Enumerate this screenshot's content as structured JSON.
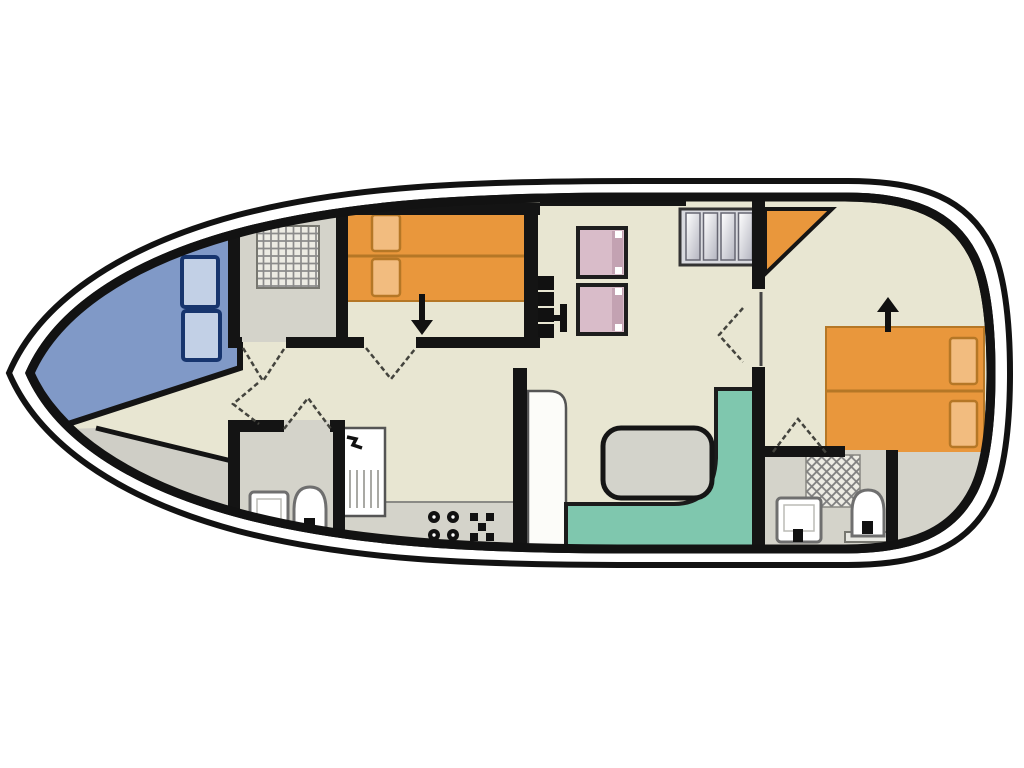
{
  "plan": {
    "type": "houseboat-deck-plan",
    "orientation": "bow-left",
    "areas": [
      "bow-seating",
      "foredeck-walkway",
      "side-deck",
      "shower-room",
      "front-cabin",
      "hallway",
      "saloon",
      "galley",
      "dinette",
      "front-bathroom",
      "aft-cabin",
      "aft-bathroom",
      "stern-locker"
    ],
    "furniture": {
      "bow_seats": 2,
      "front_cabin_double_bed": 1,
      "helm_seats": 2,
      "companionway_steps": 4,
      "stove_burners": 4,
      "dinette_table": 1,
      "aft_twin_beds": 2,
      "toilets": 2,
      "sinks": 3,
      "shower_grates": 2,
      "door_swings": 6
    },
    "colors": {
      "page_bg": "#ffffff",
      "hull_line": "#121212",
      "hull_gap": "#ffffff",
      "floor": "#e8e6d2",
      "room_gray": "#d4d3ca",
      "deck_gray": "#cfcec6",
      "wall": "#141414",
      "bow_blue": "#8099c7",
      "seat_blue_fill": "#c2d0e6",
      "seat_blue_border": "#17356e",
      "bed_orange": "#e9973c",
      "bed_orange_line": "#b57726",
      "pillow_fill": "#f2bc7f",
      "pillow_border": "#b57726",
      "seat_pink": "#d9bcc9",
      "seat_pink_dark": "#c3a2b2",
      "seat_pink_border": "#1e1e1e",
      "bench_green": "#7fc7ae",
      "bench_border": "#1c1c1c",
      "table_fill": "#d3d3cb",
      "table_border": "#151515",
      "stair_fill": "#d9dadf",
      "stair_frame": "#333333",
      "cabinet_fill": "#fcfcf9",
      "cabinet_line": "#555555",
      "fixture_fill": "#ffffff",
      "fixture_line": "#6f6f6f",
      "fixture_dark": "#111111",
      "counter_gray": "#d4d3ca",
      "counter_line": "#8a8a85",
      "swing": "#43433d",
      "black": "#111111",
      "door_leaf": "#444444",
      "drainer_line": "#a9a9a4"
    }
  }
}
